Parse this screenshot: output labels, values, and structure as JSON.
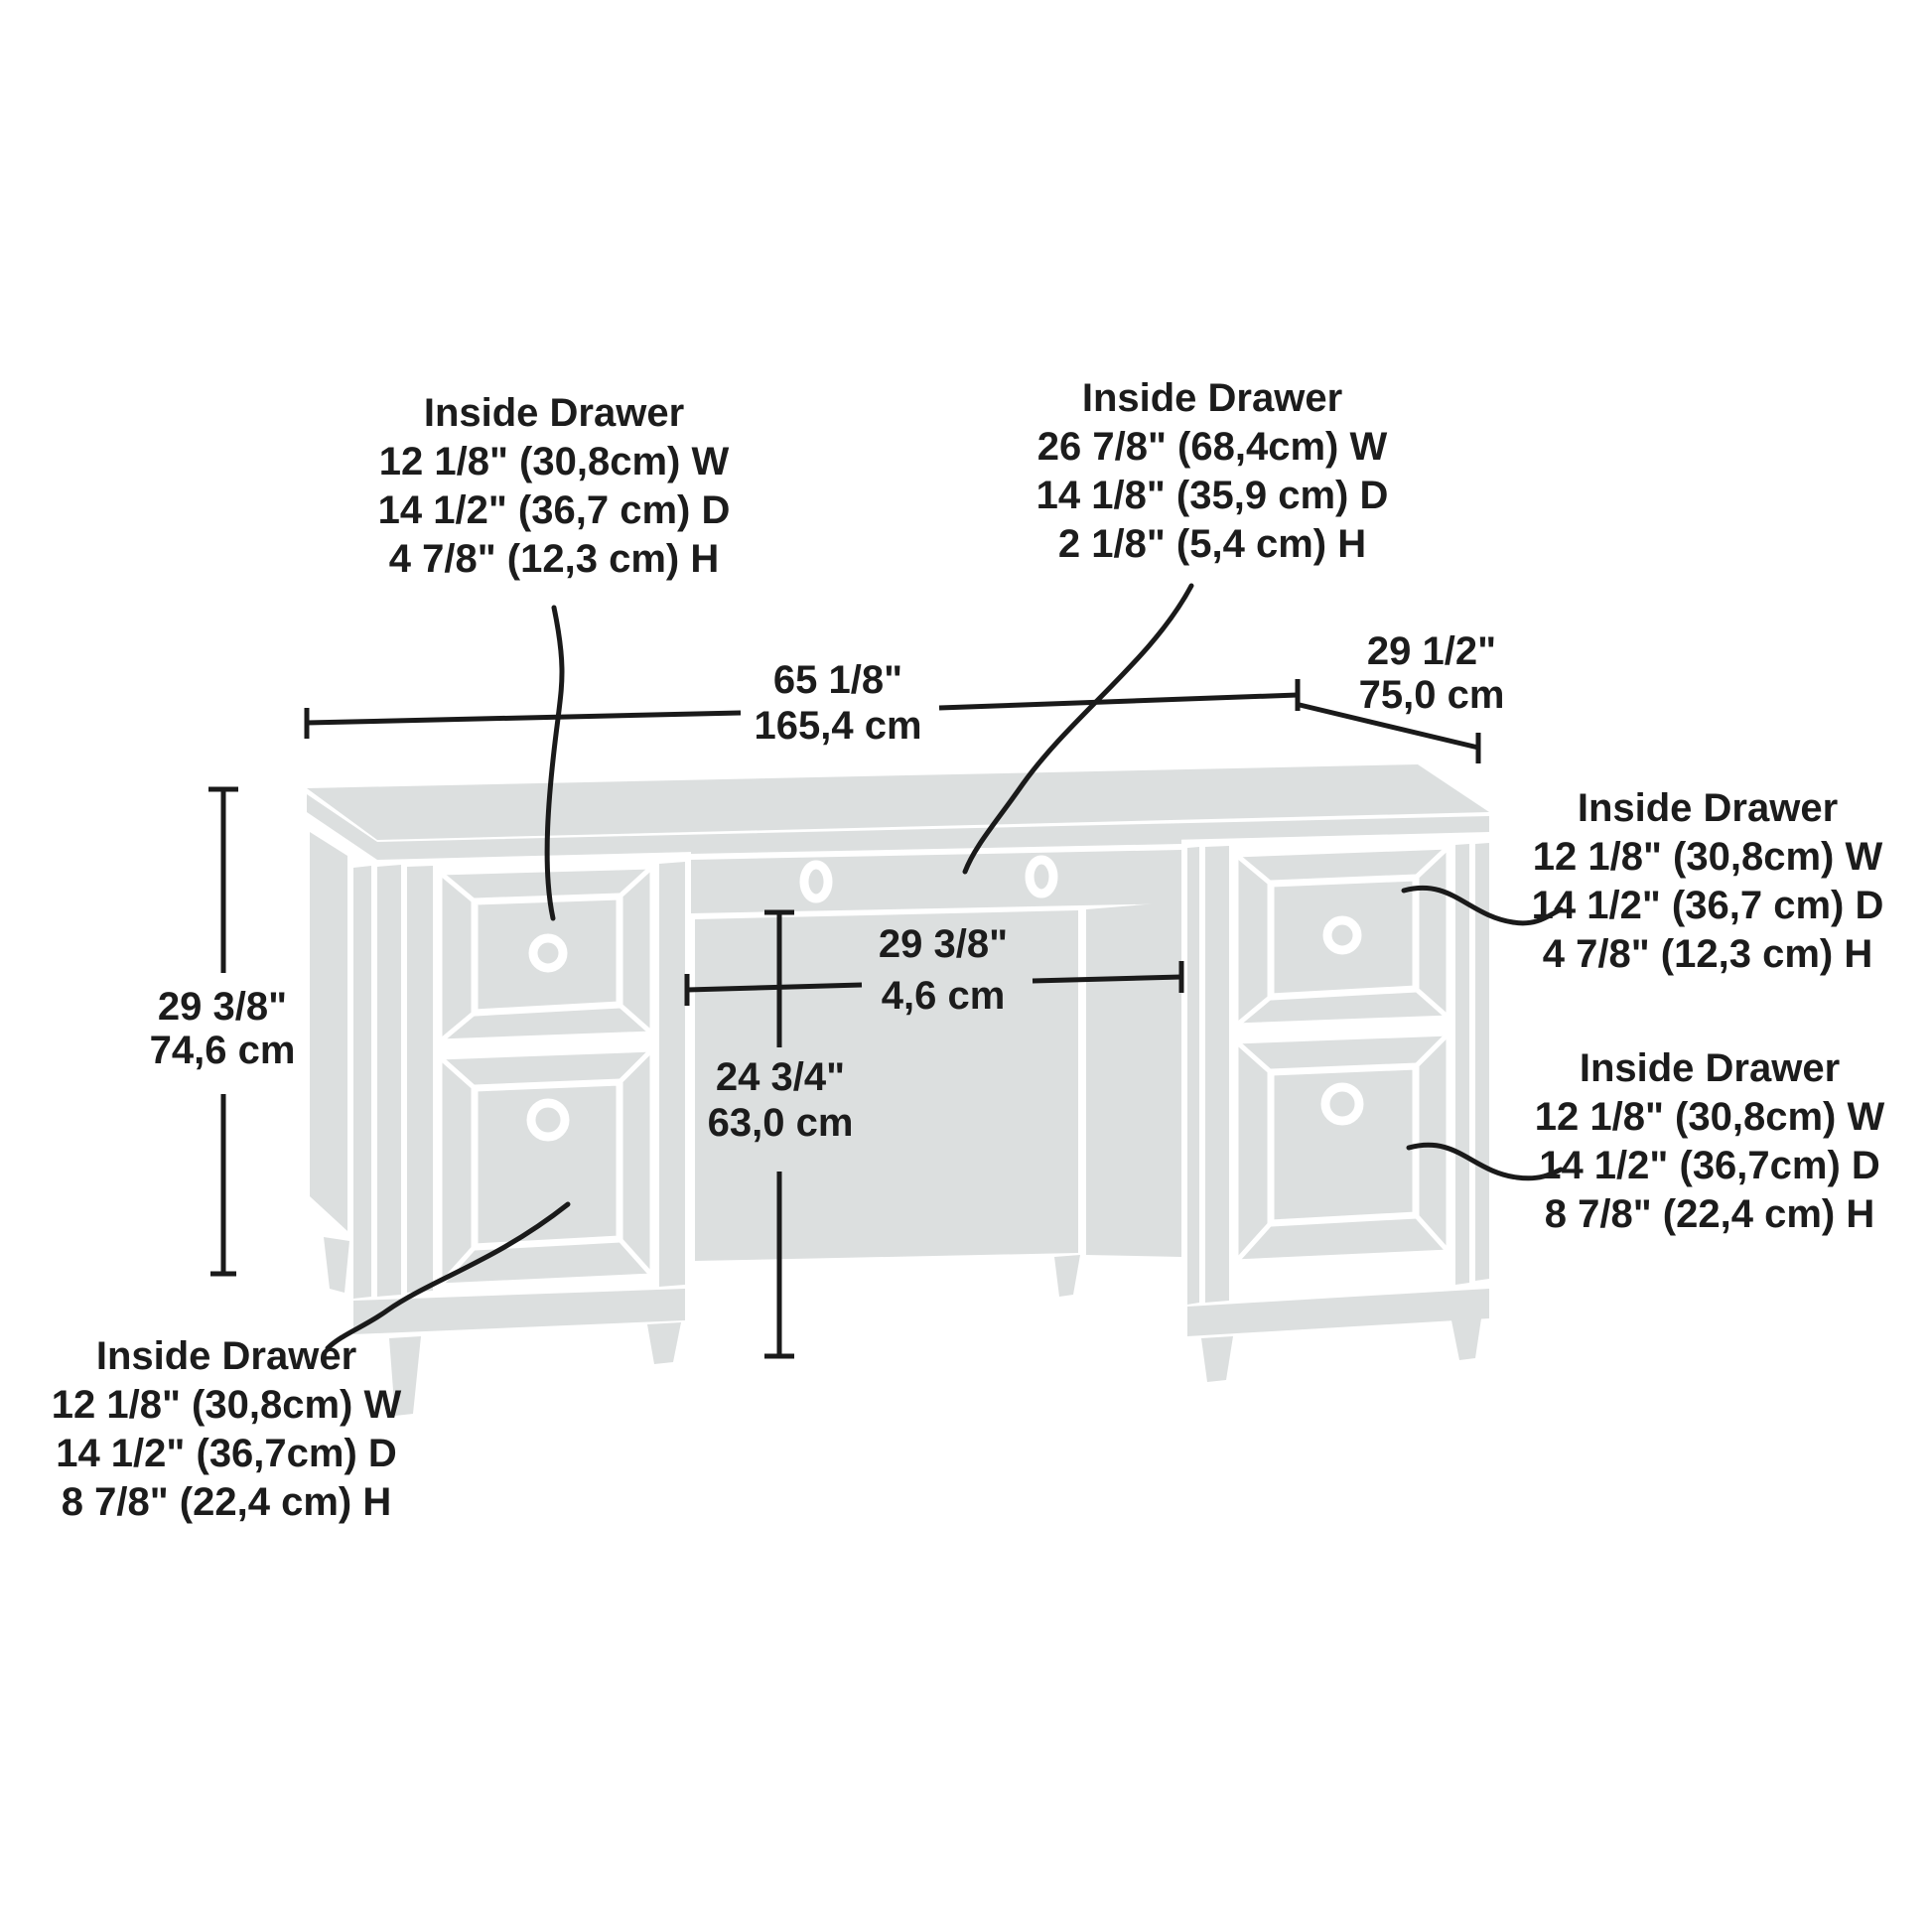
{
  "page": {
    "background": "#ffffff"
  },
  "drawing": {
    "furniture_fill": "#dcdfdf",
    "line_color": "#1a1a1a",
    "text_color": "#1c1c1c",
    "subject": "executive desk dimension diagram"
  },
  "annotations": {
    "top_left": {
      "title": "Inside Drawer",
      "lines": [
        "12 1/8\" (30,8cm) W",
        "14 1/2\" (36,7 cm) D",
        "4 7/8\" (12,3 cm) H"
      ]
    },
    "top_center": {
      "title": "Inside Drawer",
      "lines": [
        "26 7/8\" (68,4cm) W",
        "14 1/8\" (35,9 cm) D",
        "2 1/8\" (5,4 cm) H"
      ]
    },
    "right_upper": {
      "title": "Inside Drawer",
      "lines": [
        "12 1/8\" (30,8cm) W",
        "14 1/2\" (36,7 cm) D",
        "4 7/8\" (12,3 cm) H"
      ]
    },
    "right_lower": {
      "title": "Inside Drawer",
      "lines": [
        "12 1/8\" (30,8cm) W",
        "14 1/2\" (36,7cm) D",
        "8 7/8\" (22,4 cm) H"
      ]
    },
    "bottom_left": {
      "title": "Inside Drawer",
      "lines": [
        "12 1/8\" (30,8cm) W",
        "14 1/2\" (36,7cm) D",
        "8 7/8\" (22,4 cm) H"
      ]
    }
  },
  "dimensions": {
    "overall_width": {
      "imperial": "65 1/8\"",
      "metric": "165,4 cm"
    },
    "overall_depth": {
      "imperial": "29 1/2\"",
      "metric": "75,0 cm"
    },
    "overall_height": {
      "imperial": "29 3/8\"",
      "metric": "74,6 cm"
    },
    "kneehole_width": {
      "imperial": "29 3/8\"",
      "metric": "4,6 cm"
    },
    "kneehole_height": {
      "imperial": "24 3/4\"",
      "metric": "63,0 cm"
    }
  }
}
